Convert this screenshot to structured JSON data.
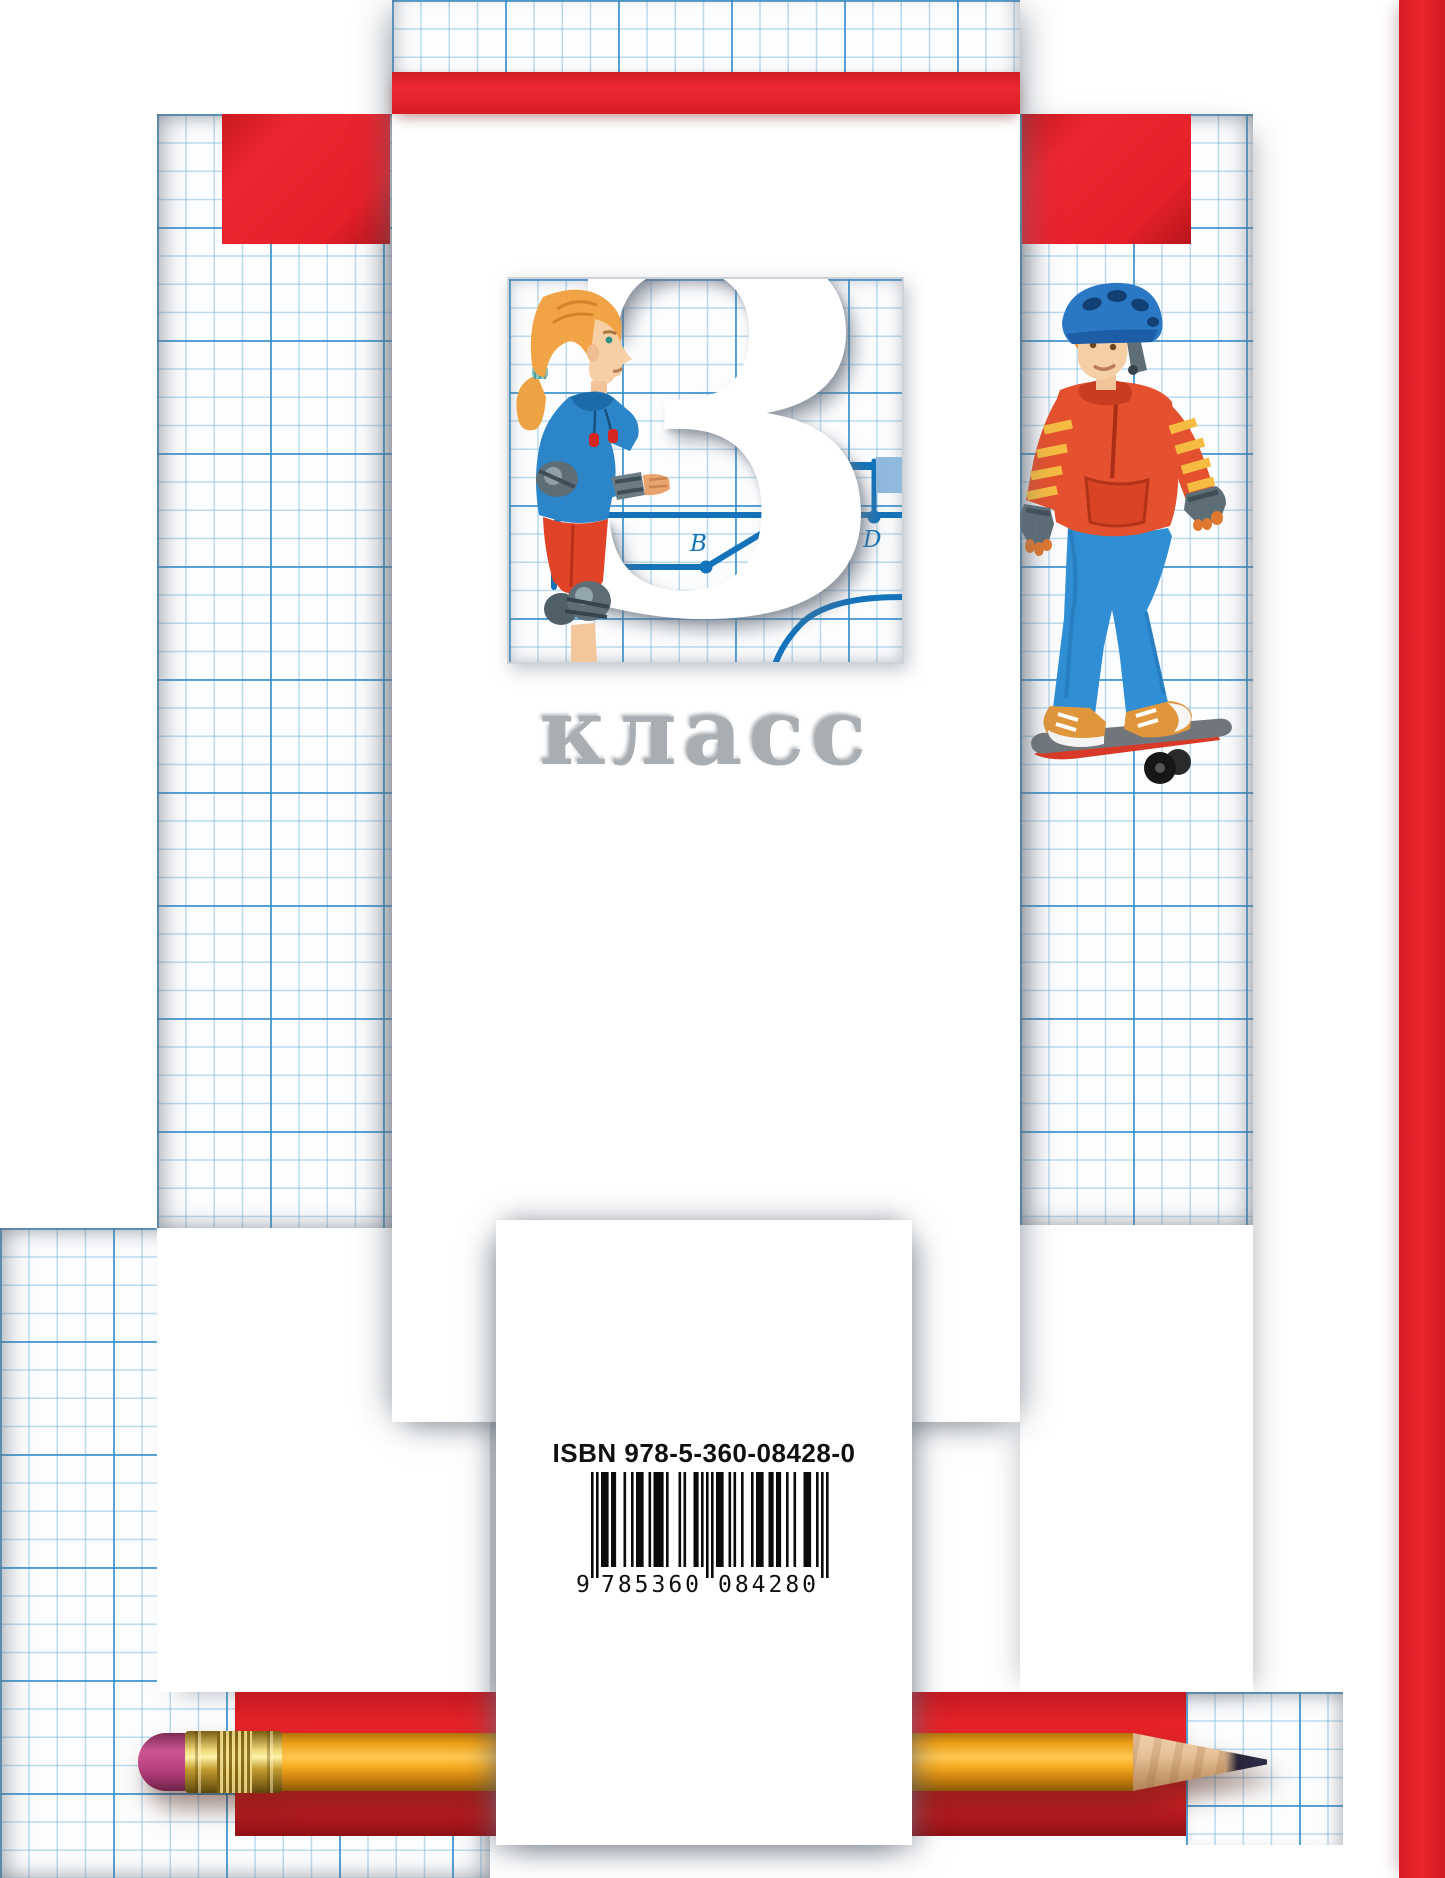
{
  "cover": {
    "grade_number": "3",
    "grade_word": "класс",
    "route_diagram": {
      "point_a": "A",
      "point_b": "B",
      "point_d": "D"
    },
    "isbn": {
      "label": "ISBN 978-5-360-08428-0",
      "ean_digits": "9785360084280",
      "display_first_digit": "9",
      "display_group1": "785360",
      "display_group2": "084280"
    },
    "colors": {
      "accent_red": "#e62329",
      "grid_blue": "#7ab6dd",
      "grid_blue_strong": "#2f8dc9",
      "route_blue": "#1473ba",
      "flag_blue": "#8fb9dd",
      "pencil_yellow": "#f7ab21",
      "eraser_pink": "#b23c79"
    },
    "illustrations": {
      "girl": "girl-rollerskater-illustration",
      "boy": "boy-skateboarder-illustration",
      "pencil": "pencil-illustration"
    }
  }
}
